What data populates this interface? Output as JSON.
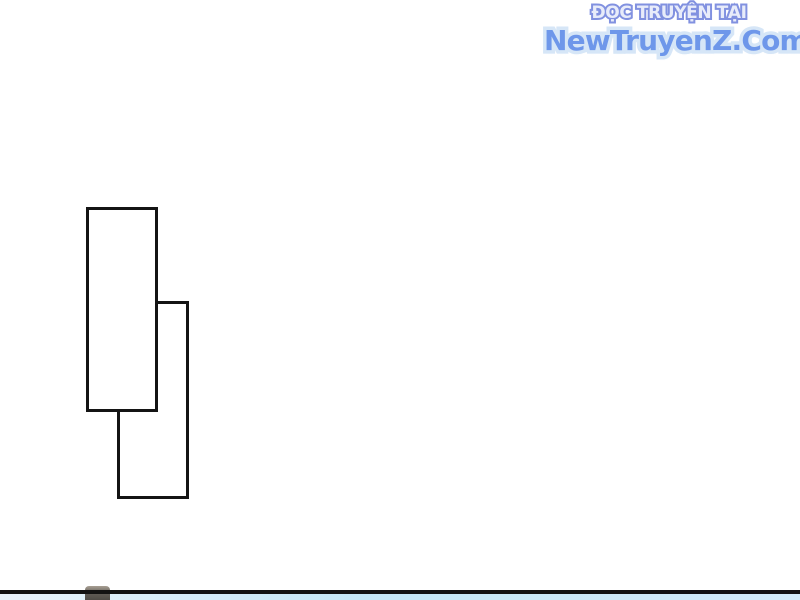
{
  "page": {
    "background": "#ffffff",
    "width": 800,
    "height": 600
  },
  "watermark": {
    "line1": {
      "text": "ĐỌC TRUYỆN TẠI",
      "fill": "#e8ecfa",
      "outline": "#8191e0"
    },
    "line2": {
      "text": "NewTruyenZ.Com",
      "fill": "#6e97ea",
      "outline": "#d6e6f7"
    }
  },
  "artwork": {
    "stroke_color": "#141414",
    "fill_color": "#ffffff",
    "stroke_width": 3.5,
    "rectangles": [
      {
        "name": "back-rectangle",
        "x": 117,
        "y": 301,
        "width": 72,
        "height": 198
      },
      {
        "name": "front-rectangle",
        "x": 86,
        "y": 207,
        "width": 72,
        "height": 205
      }
    ]
  },
  "next_panel": {
    "border_color": "#121212",
    "border_top": 590,
    "border_height": 3.5,
    "sky_colors": [
      "#e9f3fa",
      "#c3e6f6",
      "#d2ebf8"
    ],
    "peek_object": {
      "x": 85,
      "y": 586,
      "width": 25,
      "height": 14,
      "colors": [
        "#a89f93",
        "#5f5b55",
        "#4e4b46"
      ]
    }
  }
}
